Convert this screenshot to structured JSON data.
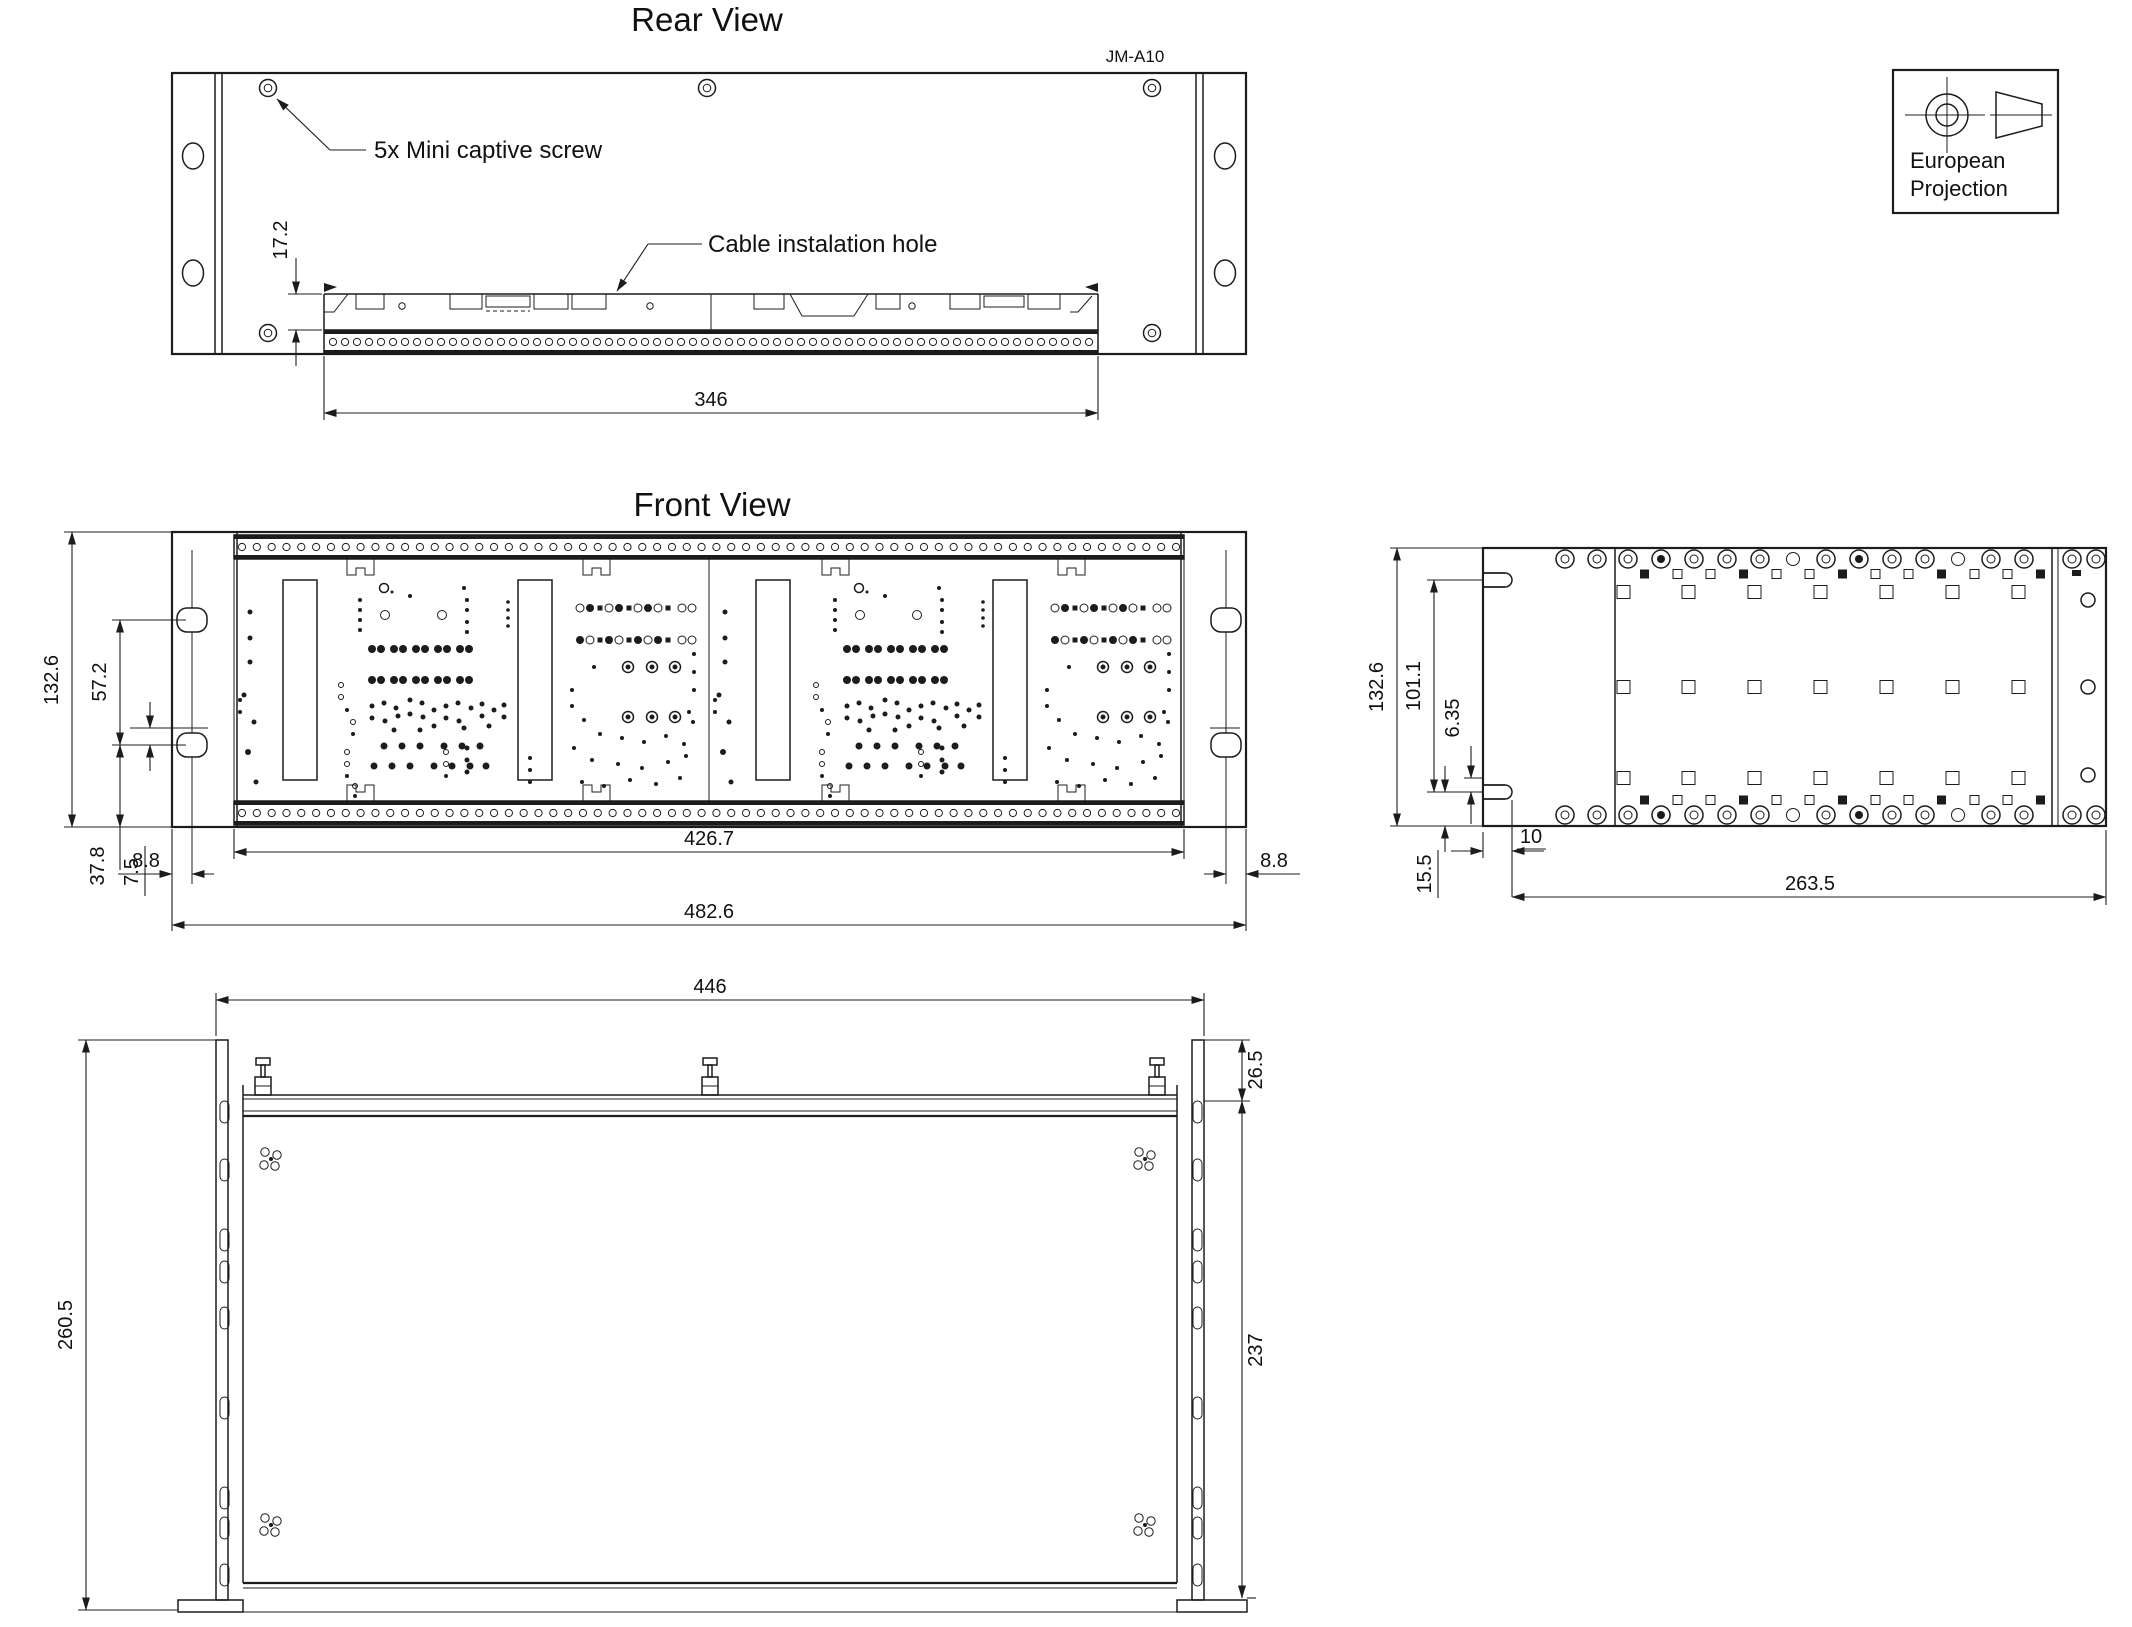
{
  "drawing": {
    "rear_view": {
      "title": "Rear View",
      "model_label": "JM-A10",
      "callout_screw": "5x Mini captive screw",
      "callout_cable": "Cable instalation hole",
      "dim_strip_offset": "17.2",
      "dim_strip_width": "346"
    },
    "front_view": {
      "title": "Front View",
      "dim_height": "132.6",
      "dim_upper": "57.2",
      "dim_lower": "37.8",
      "dim_screw_offset": "7.5",
      "dim_ear_left": "8.8",
      "dim_board_width": "426.7",
      "dim_ear_right": "8.8",
      "dim_total_width": "482.6"
    },
    "side_view": {
      "dim_height": "132.6",
      "dim_hook_span": "101.1",
      "dim_hook_offset": "6.35",
      "dim_bottom_offset": "15.5",
      "dim_hook_depth": "10",
      "dim_depth": "263.5"
    },
    "top_view": {
      "dim_width": "446",
      "dim_flange": "26.5",
      "dim_total_depth": "260.5",
      "dim_body_depth": "237"
    },
    "projection_box": {
      "line1": "European",
      "line2": "Projection"
    }
  }
}
